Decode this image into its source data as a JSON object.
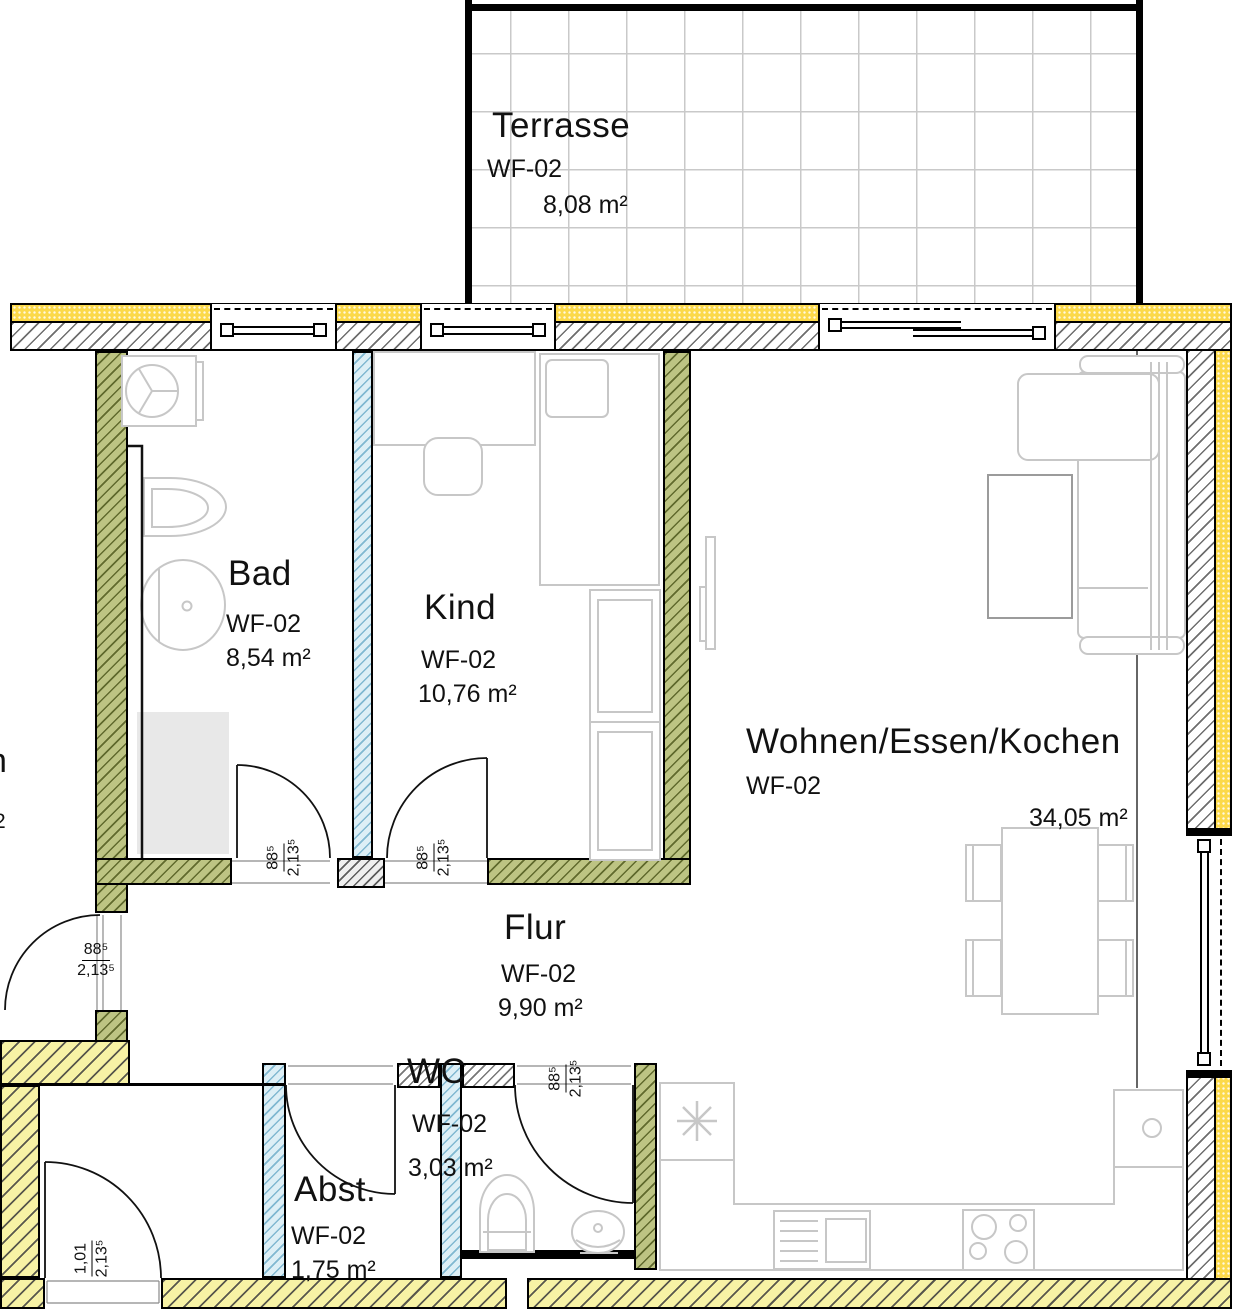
{
  "plan_title": "Apartment floor plan WF-02",
  "rooms": {
    "terrasse": {
      "name": "Terrasse",
      "code": "WF-02",
      "area": "8,08 m²"
    },
    "bad": {
      "name": "Bad",
      "code": "WF-02",
      "area": "8,54 m²"
    },
    "kind": {
      "name": "Kind",
      "code": "WF-02",
      "area": "10,76 m²"
    },
    "wohnen": {
      "name": "Wohnen/Essen/Kochen",
      "code": "WF-02",
      "area": "34,05 m²"
    },
    "flur": {
      "name": "Flur",
      "code": "WF-02",
      "area": "9,90 m²"
    },
    "wc": {
      "name": "WC",
      "code": "WF-02",
      "area": "3,03 m²"
    },
    "abst": {
      "name": "Abst.",
      "code": "WF-02",
      "area": "1,75 m²"
    }
  },
  "dims": {
    "bad_door": {
      "num": "88⁵",
      "den": "2,13⁵"
    },
    "kind_door": {
      "num": "88⁵",
      "den": "2,13⁵"
    },
    "wc_door": {
      "num": "88⁵",
      "den": "2,13⁵"
    },
    "entry_door": {
      "num": "88⁵",
      "den": "2,13⁵"
    },
    "exterior_door": {
      "num": "1,01",
      "den": "2,13⁵"
    }
  },
  "fragments": {
    "neighbor_room_cut": "n",
    "neighbor_sup_cut": "2"
  },
  "colors": {
    "insulation_yellow": "#fcd94a",
    "wall_olive": "#bdc483",
    "wall_lightblue": "#ddeff6",
    "wall_paleyellow": "#f7f2a5",
    "wall_hatch_gray": "#6e6e6e",
    "furniture_gray": "#c7c7c7",
    "terrace_grid": "#c9c9c9"
  }
}
